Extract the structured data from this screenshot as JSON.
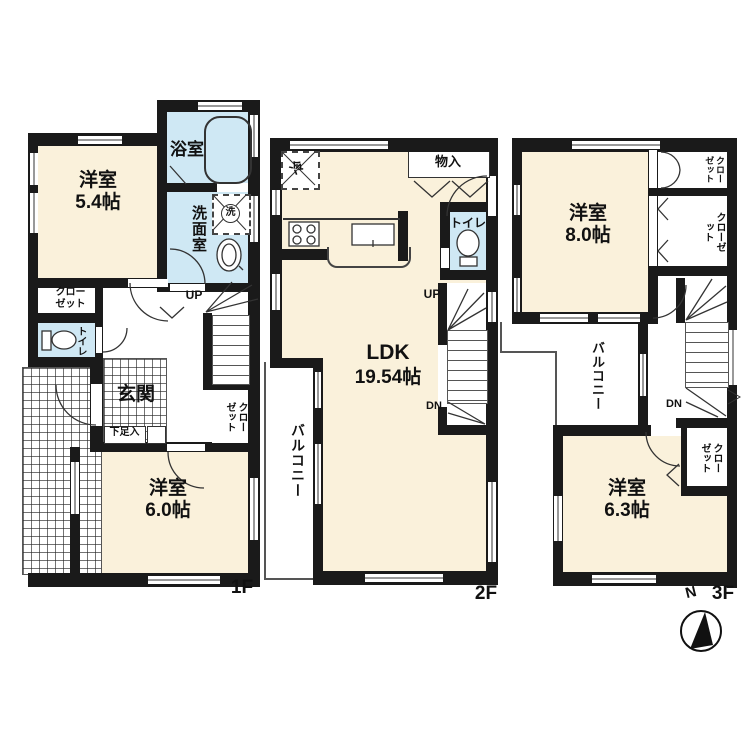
{
  "colors": {
    "room_fill": "#FAF1DB",
    "wet_fill": "#CFE8F4",
    "wall": "#1A1A1A"
  },
  "f1": {
    "floor_label": "1F",
    "bath": "浴室",
    "washer": "洗",
    "washroom": "洗面室",
    "room54_name": "洋室",
    "room54_size": "5.4帖",
    "closet_line1": "クロー",
    "closet_line2": "ゼット",
    "toilet": "トイレ",
    "genkan": "玄関",
    "shoebox": "下足入",
    "up": "UP",
    "stair_closet": "クローゼット",
    "room60_name": "洋室",
    "room60_size": "6.0帖"
  },
  "f2": {
    "floor_label": "2F",
    "fridge": "冷",
    "storage": "物入",
    "toilet": "トイレ",
    "up": "UP",
    "dn": "DN",
    "ldk_name": "LDK",
    "ldk_size": "19.54帖",
    "balcony": "バルコニー"
  },
  "f3": {
    "floor_label": "3F",
    "room80_name": "洋室",
    "room80_size": "8.0帖",
    "closet1": "クローゼット",
    "closet2": "クローゼット",
    "closet3": "クローゼット",
    "balcony": "バルコニー",
    "dn": "DN",
    "room63_name": "洋室",
    "room63_size": "6.3帖",
    "compass_n": "N"
  }
}
